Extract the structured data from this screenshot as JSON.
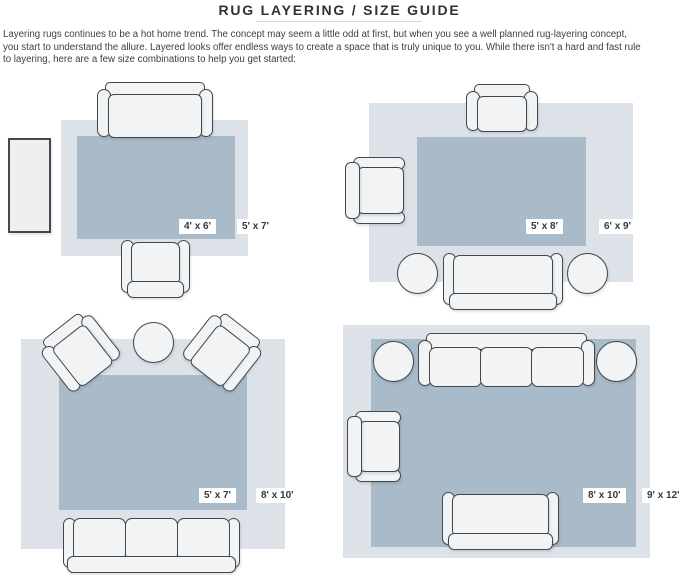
{
  "header": {
    "title": "RUG LAYERING / SIZE GUIDE"
  },
  "intro": {
    "lines": [
      "Layering rugs continues to be a hot home trend. The concept may seem a little odd at first, but when you see a well planned rug-layering concept,",
      "you start to understand the allure. Layered looks offer endless ways to create a space that is truly unique to you. While there isn't a hard and fast rule",
      "to layering, here are a few size combinations to help you get started:"
    ]
  },
  "colors": {
    "outer_rug": "#dce2e8",
    "inner_rug": "#a9bac8",
    "furniture_fill": "#f1f3f4",
    "furniture_outline": "#42474c",
    "label_background": "#ffffff",
    "label_text": "#35383c"
  },
  "layouts": [
    {
      "position": "top-left",
      "inner_rug_size": "4' x 6'",
      "outer_rug_size": "5' x 7'",
      "furniture": [
        "sofa",
        "armchair",
        "console table"
      ]
    },
    {
      "position": "top-right",
      "inner_rug_size": "5' x 8'",
      "outer_rug_size": "6' x 9'",
      "furniture": [
        "armchair",
        "armchair",
        "sofa",
        "pouf",
        "pouf"
      ]
    },
    {
      "position": "bottom-left",
      "inner_rug_size": "5' x 7'",
      "outer_rug_size": "8' x 10'",
      "furniture": [
        "armchair",
        "armchair",
        "round side table",
        "sofa"
      ]
    },
    {
      "position": "bottom-right",
      "inner_rug_size": "8' x 10'",
      "outer_rug_size": "9' x 12'",
      "furniture": [
        "sofa",
        "pouf",
        "pouf",
        "armchair",
        "loveseat"
      ]
    }
  ]
}
